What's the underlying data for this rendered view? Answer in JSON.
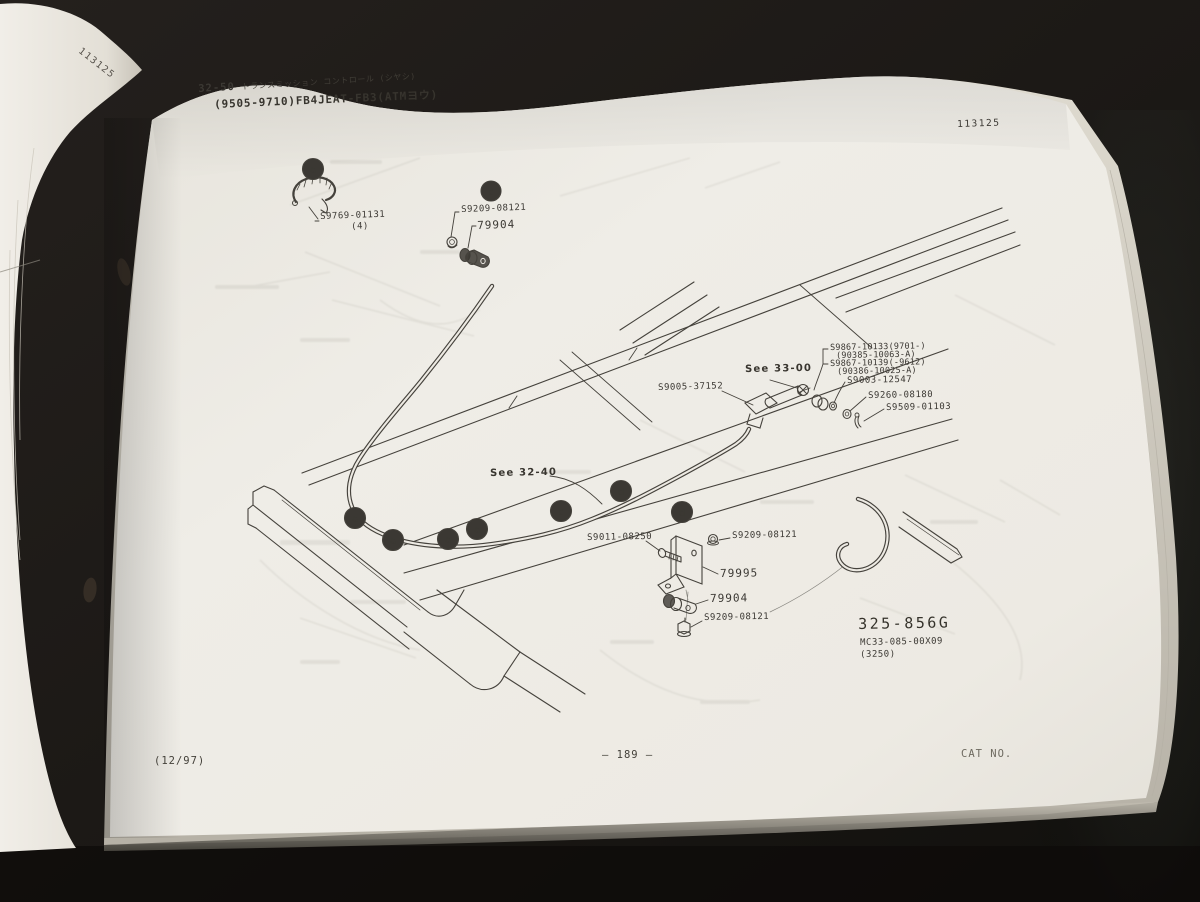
{
  "photo": {
    "left_page_corner_stamp": "113125",
    "page_code_top_right": "113125"
  },
  "header": {
    "section_code": "32-50",
    "title_kana": "トランスミッション コントロール (シヤシ)",
    "subtitle": "(9505-9710)FB4JEAT-FB3(ATMヨウ)"
  },
  "diagram": {
    "callouts": {
      "clip_part": "S9769-01131",
      "clip_qty": "(4)",
      "c_nut": "S9209-08121",
      "c_clamp": "79904",
      "see_33_00": "See 33-00",
      "cable": "S9005-37152",
      "bush_new": "S9867-10133(9701-)",
      "bush_new_alt": "(90385-10063-A)",
      "bush_old": "S9867-10139(-9612)",
      "bush_old_alt": "(90386-10025-A)",
      "washer": "S9003-12547",
      "spacer": "S9260-08180",
      "pin": "S9509-01103",
      "see_32_40": "See 32-40",
      "bolt": "S9011-08250",
      "d_nut_upper": "S9209-08121",
      "bracket": "79995",
      "d_clamp": "79904",
      "d_nut_lower": "S9209-08121"
    },
    "markers": {
      "detail_a": "a",
      "detail_c": "c",
      "f1": "a",
      "f2": "a",
      "f3": "a",
      "f4": "a",
      "f5": "c",
      "f6": "d",
      "f7": "d"
    },
    "figure": {
      "code": "325-856G",
      "drawing_no": "MC33-085-00X09",
      "note": "(3250)"
    }
  },
  "footer": {
    "issue_date": "(12/97)",
    "page_number": "— 189 —",
    "cat_no": "CAT NO."
  }
}
